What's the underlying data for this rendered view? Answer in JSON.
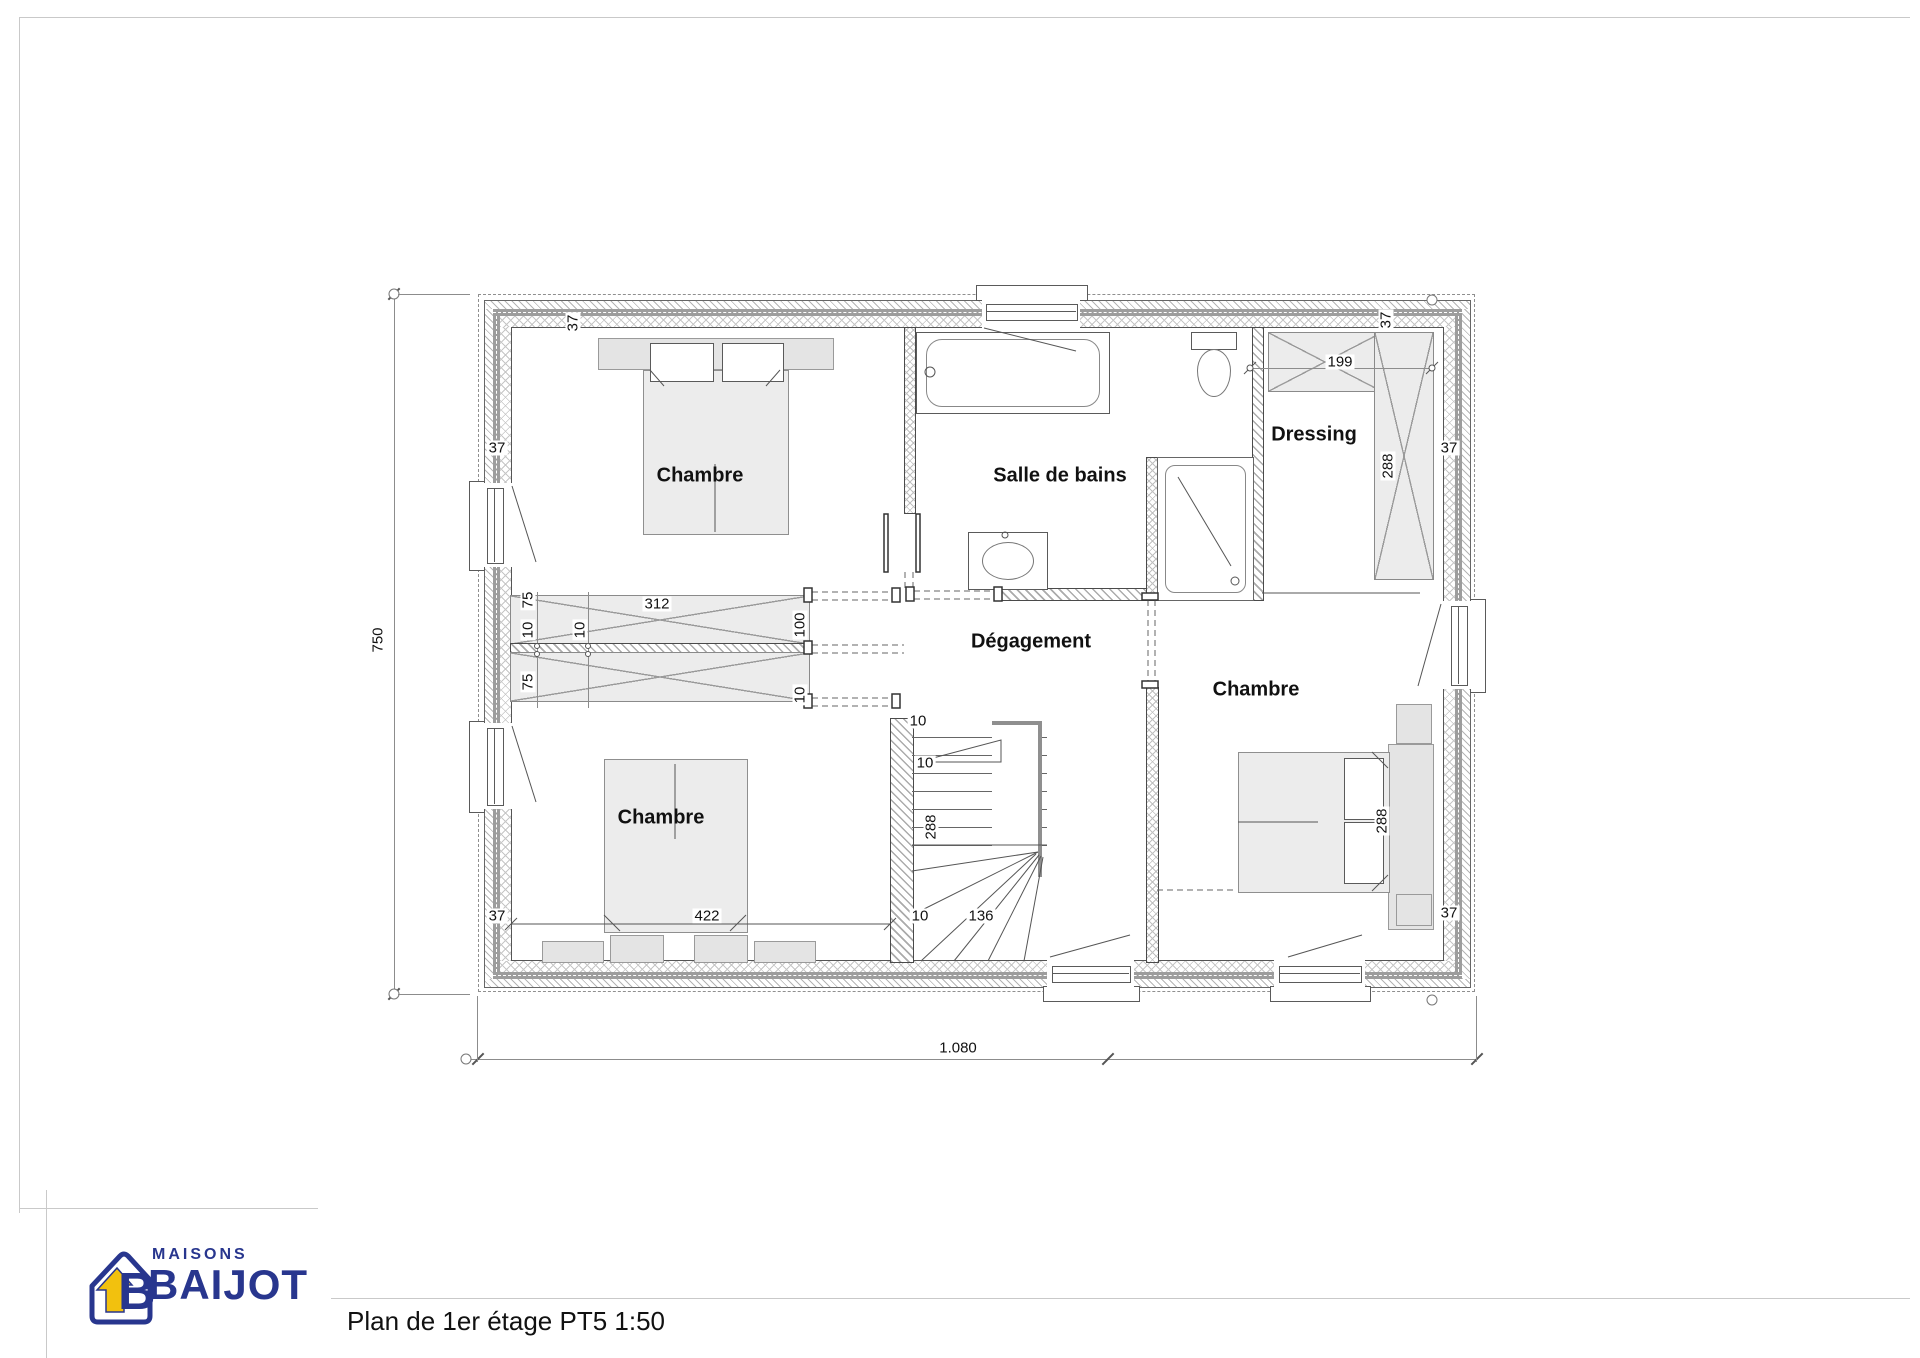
{
  "sheet": {
    "title": "Plan de 1er étage PT5 1:50"
  },
  "logo": {
    "word_top": "MAISONS",
    "word_main": "BAIJOT",
    "monogram": "B",
    "blue": "#28368e",
    "yellow": "#f2c10e"
  },
  "rooms": {
    "chambre_tl": "Chambre",
    "salle_de_bains": "Salle de bains",
    "dressing": "Dressing",
    "degagement": "Dégagement",
    "chambre_droite": "Chambre",
    "chambre_bl": "Chambre"
  },
  "dims": {
    "total_width": "1.080",
    "total_height": "750",
    "wall": "37",
    "beam_length": "312",
    "beam_75": "75",
    "t10": "10",
    "opening": "100",
    "stair_depth": "288",
    "stair_width": "136",
    "room_width": "422",
    "dressing_width": "199",
    "dressing_side": "288",
    "bed_side": "288"
  },
  "colors": {
    "wall_gray": "#9d9d9d",
    "hatch": "#b5b5b5",
    "furniture_fill": "#ececec",
    "line": "#555555"
  }
}
